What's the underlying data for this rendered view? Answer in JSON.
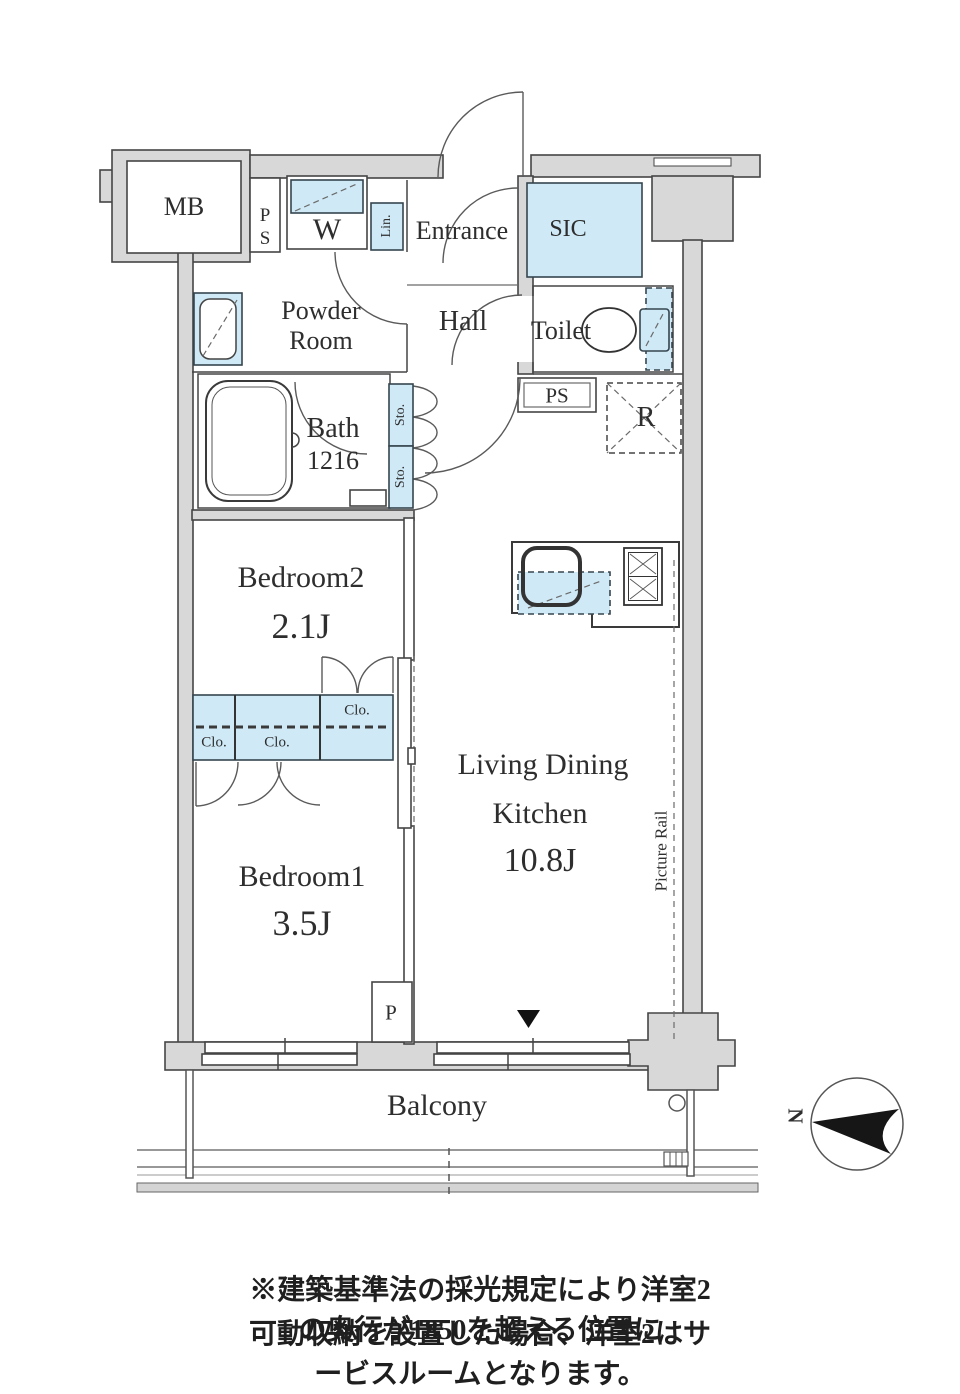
{
  "plan": {
    "rooms": {
      "mb": "MB",
      "ps_top": "PS",
      "washer": "W",
      "linen": "Lin.",
      "entrance": "Entrance",
      "sic": "SIC",
      "powder_line1": "Powder",
      "powder_line2": "Room",
      "hall": "Hall",
      "toilet": "Toilet",
      "bath": "Bath",
      "bath_size": "1216",
      "storage1": "Sto.",
      "storage2": "Sto.",
      "ps_mid": "PS",
      "fridge": "R",
      "bedroom2": "Bedroom2",
      "bedroom2_size": "2.1J",
      "closet1": "Clo.",
      "closet2": "Clo.",
      "closet3": "Clo.",
      "ldk_line1": "Living Dining",
      "ldk_line2": "Kitchen",
      "ldk_size": "10.8J",
      "picture_rail": "Picture Rail",
      "bedroom1": "Bedroom1",
      "bedroom1_size": "3.5J",
      "pipe": "P",
      "balcony": "Balcony"
    },
    "compass_n": "N",
    "colors": {
      "wall": "#d8d8d8",
      "fixture_blue": "#cfe9f6",
      "line": "#454545"
    }
  },
  "note": {
    "line1": "※建築基準法の採光規定により洋室2の奥行が1850を超える位置に",
    "line2": "可動収納を設置した場合、洋室2はサービスルームとなります。"
  }
}
